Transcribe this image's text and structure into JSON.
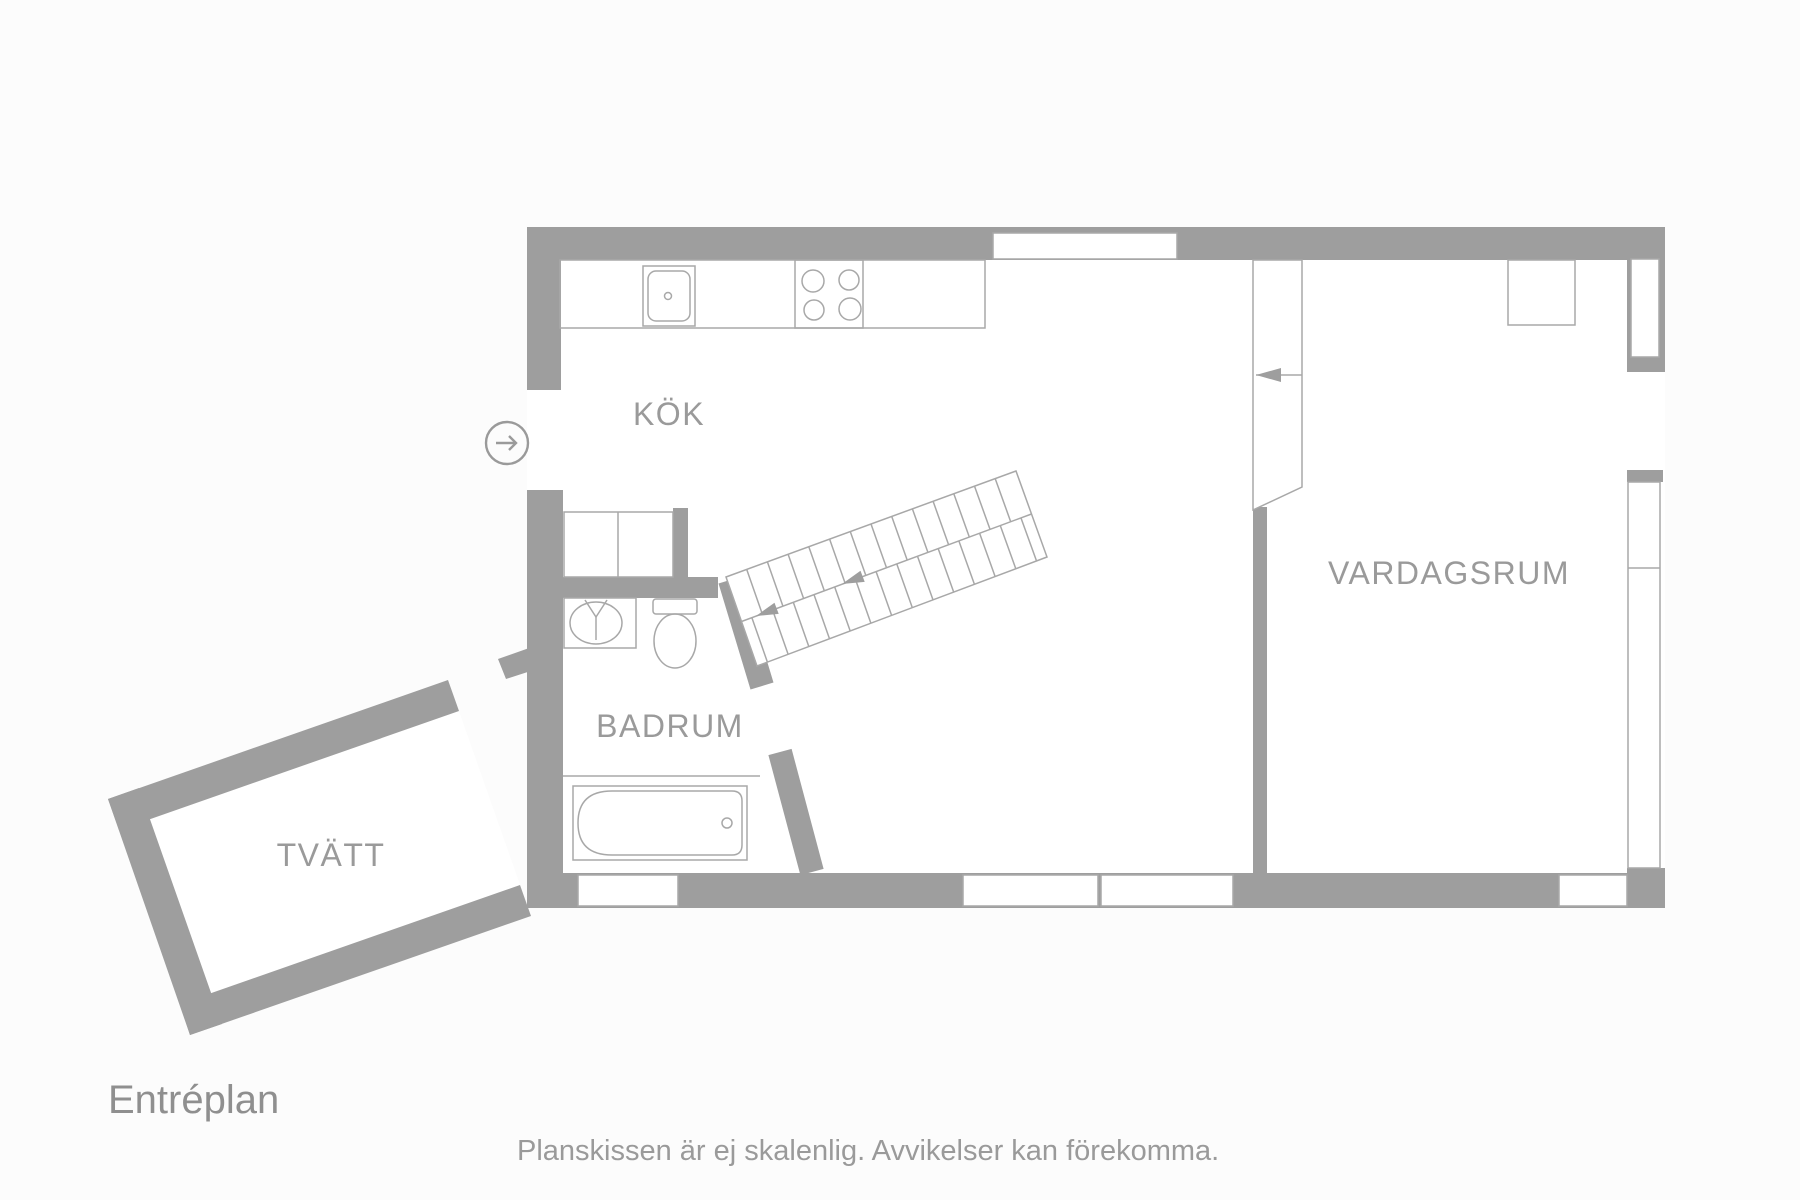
{
  "plan": {
    "title": "Entréplan",
    "disclaimer": "Planskissen är ej skalenlig. Avvikelser kan förekomma.",
    "rooms": [
      {
        "id": "kok",
        "label": "KÖK"
      },
      {
        "id": "vardagsrum",
        "label": "VARDAGSRUM"
      },
      {
        "id": "badrum",
        "label": "BADRUM"
      },
      {
        "id": "tvatt",
        "label": "TVÄTT"
      }
    ],
    "fixtures": [
      "kitchen-sink",
      "stove-4-burners",
      "wardrobe",
      "fireplace",
      "bathroom-sink",
      "toilet",
      "bathtub",
      "staircase",
      "upper-stair-flight"
    ],
    "icons": {
      "entry_arrow": "right-arrow-in-circle",
      "stair_direction": "left-down-arrows"
    },
    "colors": {
      "wall": "#9e9e9e",
      "line": "#a8a8a8",
      "text": "#9a9a9a",
      "title": "#8f8f8f",
      "floor": "#ffffff"
    }
  }
}
